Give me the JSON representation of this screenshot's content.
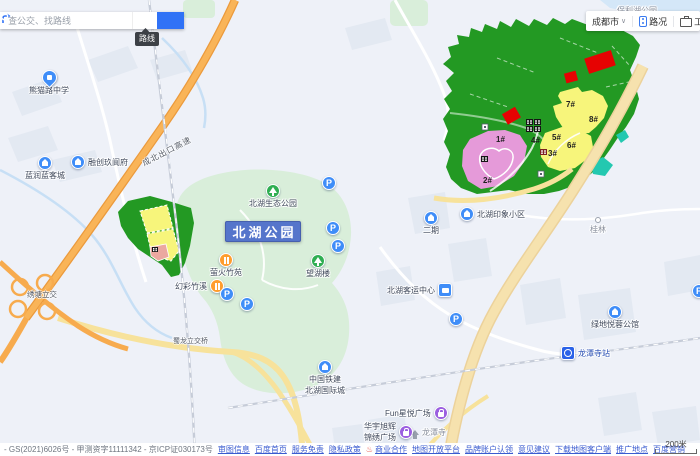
{
  "search": {
    "placeholder": "查公交、找路线",
    "route_tooltip": "路线"
  },
  "topbar": {
    "city": "成都市",
    "traffic": "路况",
    "toolbox": "工具箱"
  },
  "icons": {
    "parking": "P",
    "caret": "∨",
    "hot": "♨"
  },
  "plots": {
    "p1": "1#",
    "p2": "2#",
    "p3": "3#",
    "p4": "4#",
    "p5": "5#",
    "p6": "6#",
    "p7": "7#",
    "p8": "8#"
  },
  "park": {
    "main_label": "北湖公园"
  },
  "pois": {
    "panda_school": "熊猫路中学",
    "lanrun": "蓝润蓝客城",
    "rongchuang": "融创玖阆府",
    "expressway": "成北出口高速",
    "eco_park": "北湖生态公园",
    "yinghuo": "萤火竹苑",
    "wanghulou": "望湖楼",
    "huancai": "幻彩竹溪",
    "interchange": "绣塘立交",
    "shulong_bridge": "蜀龙立交桥",
    "impression": "北湖印象小区",
    "erqi": "二期",
    "bus_center": "北湖客运中心",
    "guilin": "桂林",
    "lvdi": "绿地悦蓉公馆",
    "crcc_line1": "中国铁建",
    "crcc_line2": "北湖国际城",
    "metro_station": "龙潭寺站",
    "longtan_temple": "龙潭寺",
    "fun_plaza": "Fun星悦广场",
    "huayu_line1": "华宇旭辉",
    "huayu_line2": "锦绣广场",
    "clipped_park": "保利湖公园"
  },
  "scalebar": {
    "text": "200米"
  },
  "footer": {
    "copyright": "- GS(2021)6026号 - 甲测资字11111342 - 京ICP证030173号",
    "links": [
      "审图信息",
      "百度首页",
      "服务免责",
      "隐私政策",
      "商业合作",
      "地图开放平台",
      "品牌账户认领",
      "意见建议",
      "下载地图客户端",
      "推广地点",
      "百度营销"
    ]
  },
  "colors": {
    "accent_blue": "#3072f6",
    "zone_green": "#239923",
    "zone_yellow": "#f7f57b",
    "zone_pink": "#e59ad9",
    "zone_red": "#e60202",
    "zone_teal": "#23c8b0",
    "park_green": "#d9eeda",
    "highway_orange": "#f7ab4e",
    "park_label_bg": "#5575cb"
  }
}
